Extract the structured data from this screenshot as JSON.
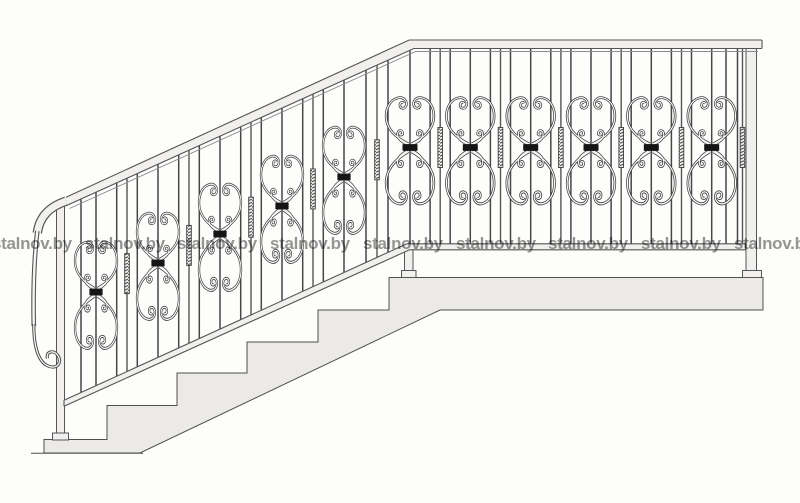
{
  "page": {
    "description": "Scanned catalogue drawing of a wrought-iron staircase railing, side elevation, with decorative scrolled butterfly panels and repeated watermark"
  },
  "watermark": {
    "text": "stalnov.by",
    "color_hex": "#6d6d6d",
    "row_top_px": 235,
    "start_x_px": -8,
    "pitch_x_px": 92.7,
    "count": 9
  },
  "drawing": {
    "description": "Forged railing: sloped stair flight on the left ending in a volute scroll, horizontal landing rail on the right, concrete steps and landing slab below",
    "ink_hex": "#3f3f3f",
    "light_fill_hex": "#f1f0ee",
    "step_fill_hex": "#ebeae7",
    "collar_hex": "#151515",
    "railing": {
      "stair_panels": [
        {
          "cx": 96,
          "cy": 292
        },
        {
          "cx": 158,
          "cy": 263
        },
        {
          "cx": 220,
          "cy": 234
        },
        {
          "cx": 282,
          "cy": 206
        },
        {
          "cx": 344,
          "cy": 177
        }
      ],
      "horizontal_panels": [
        {
          "cx": 410,
          "cy": 147.5
        },
        {
          "cx": 470.3,
          "cy": 147.5
        },
        {
          "cx": 530.7,
          "cy": 147.5
        },
        {
          "cx": 591,
          "cy": 147.5
        },
        {
          "cx": 651.3,
          "cy": 147.5
        },
        {
          "cx": 711.7,
          "cy": 147.5
        }
      ],
      "plain_bars_x": [
        81,
        116.7,
        137.3,
        178.7,
        199.3,
        240.7,
        261.3,
        302.7,
        323.3,
        366,
        388,
        430.1,
        450.2,
        490.4,
        510.5,
        550.8,
        570.9,
        611.1,
        631.2,
        671.4,
        691.5,
        726,
        737.5
      ],
      "twisted_bars_x": [
        127,
        189,
        251,
        313,
        377,
        440.2,
        500.5,
        560.9,
        621.2,
        681.5,
        742.5
      ]
    }
  }
}
